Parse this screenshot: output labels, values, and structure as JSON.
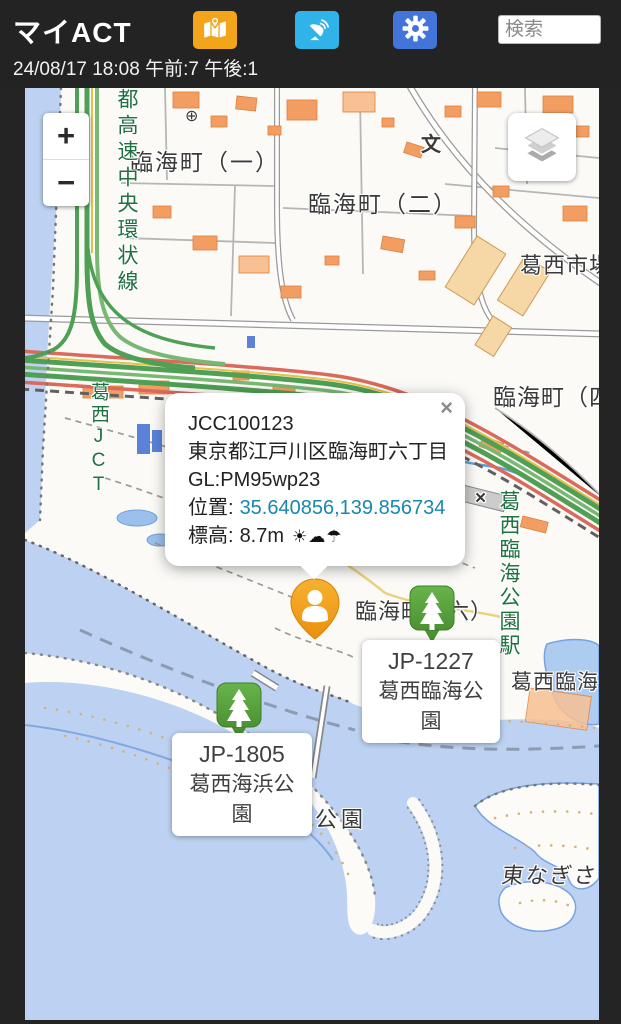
{
  "colors": {
    "header_bg": "#232323",
    "map_button": "#F2A41B",
    "satellite_button": "#2FB3E8",
    "settings_button": "#4374D9",
    "user_marker": "#F0A01E",
    "station_marker": "#55A23B",
    "coordinates_link": "#1A87AC",
    "water": "#BDD2F2",
    "expressway_green": "#4F9F55",
    "expressway_red": "#D96A5C"
  },
  "header": {
    "title": "マイACT",
    "status": "24/08/17 18:08 午前:7 午後:1",
    "search_placeholder": "検索"
  },
  "map_controls": {
    "zoom_in": "+",
    "zoom_out": "−"
  },
  "popup": {
    "close": "×",
    "station_id": "JCC100123",
    "address": "東京都江戸川区臨海町六丁目",
    "grid_locator": "GL:PM95wp23",
    "position_label": "位置:",
    "position_value": "35.640856,139.856734",
    "elevation_label": "標高:",
    "elevation_value": "8.7m",
    "weather": "☀☁☂"
  },
  "markers": [
    {
      "id": "JP-1227",
      "name": "葛西臨海公園"
    },
    {
      "id": "JP-1805",
      "name": "葛西海浜公園"
    }
  ],
  "map_labels": [
    {
      "text": "臨海町（一）"
    },
    {
      "text": "臨海町（二）"
    },
    {
      "text": "葛西市場"
    },
    {
      "text": "臨海町（四）"
    },
    {
      "text": "臨海町（六）"
    },
    {
      "text": "葛西臨海公園"
    },
    {
      "text": "葛西海浜公園"
    },
    {
      "text": "東なぎさ"
    },
    {
      "text": "都高速中央環状線"
    },
    {
      "text": "葛西JCT"
    },
    {
      "text": "葛西臨海公園駅"
    },
    {
      "text": "文"
    },
    {
      "text": "⊕"
    },
    {
      "text": "×"
    }
  ]
}
